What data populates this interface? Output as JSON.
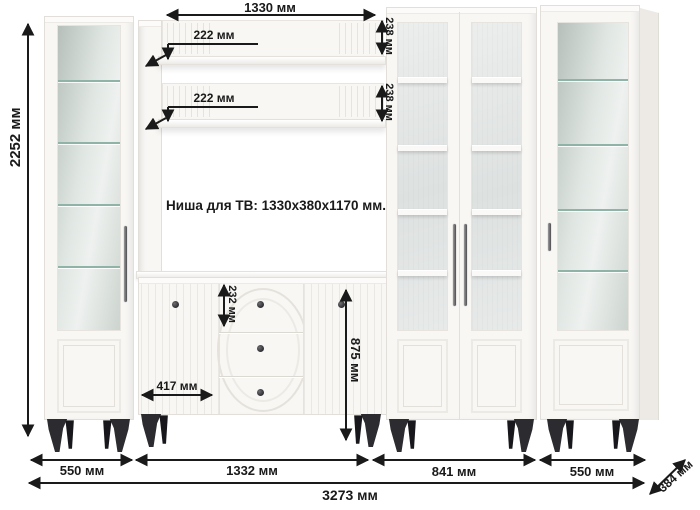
{
  "note": {
    "tv_niche": "Ниша для ТВ: 1330х380х1170 мм."
  },
  "dims": {
    "height_total": "2252 мм",
    "niche_width": "1330 мм",
    "shelf_depth_top": "222 мм",
    "shelf_depth_bottom": "222 мм",
    "shelf_back_height_top": "238 мм",
    "shelf_back_height_bottom": "238 мм",
    "drawer_height": "232 мм",
    "door_width": "417 мм",
    "stand_height": "875 мм",
    "w_left_cabinet": "550 мм",
    "w_tv_stand": "1332 мм",
    "w_middle_cabinets": "841 мм",
    "w_right_cabinet": "550 мм",
    "w_total": "3273 мм",
    "depth": "384 мм"
  },
  "colors": {
    "dimension_text": "#1a1a1a",
    "furniture_white": "#f8f7f4",
    "leg_black": "#2b2b30",
    "shelf_glass_line": "#8fb3a7"
  }
}
